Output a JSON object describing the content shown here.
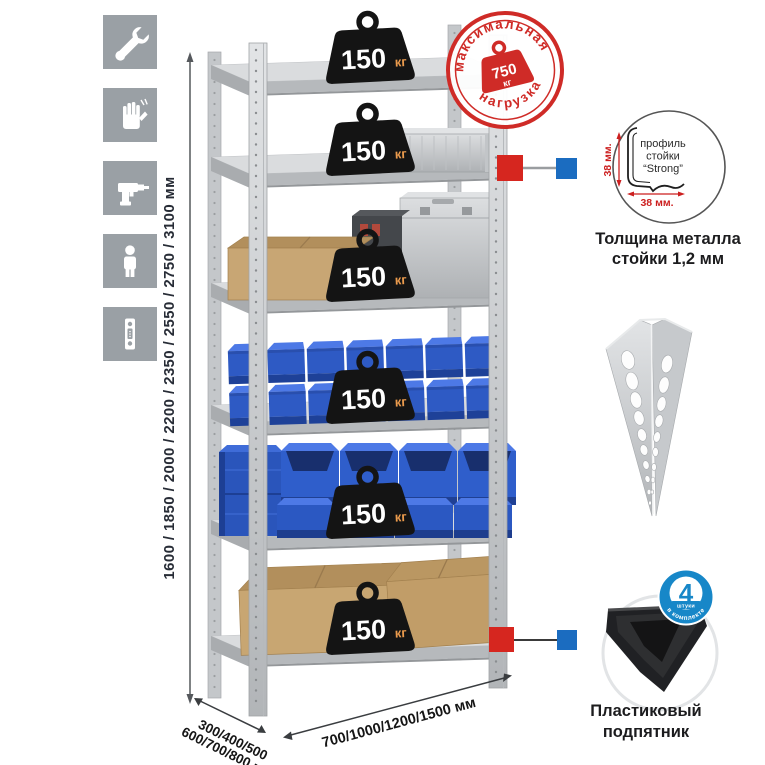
{
  "left_icons": {
    "items": [
      "wrench-icon",
      "gloves-icon",
      "drill-icon",
      "person-icon",
      "perforated-post-icon"
    ]
  },
  "dimensions": {
    "height": "1600 / 1850 / 2000 / 2200 / 2350 / 2550 / 2750 / 3100 мм",
    "depth_line1": "300/400/500",
    "depth_line2": "600/700/800 мм",
    "width": "700/1000/1200/1500 мм"
  },
  "max_load_stamp": {
    "arc_top": "максимальная",
    "arc_bottom": "нагрузка",
    "value": "750",
    "unit": "кг"
  },
  "shelf_load": {
    "value": "150",
    "unit": "кг"
  },
  "profile_detail": {
    "line1": "профиль",
    "line2": "стойки",
    "line3": "“Strong”",
    "dim_vertical": "38 мм.",
    "dim_horizontal": "38 мм.",
    "caption_line1": "Толщина металла",
    "caption_line2": "стойки 1,2 мм"
  },
  "foot_detail": {
    "badge_value": "4",
    "badge_unit": "штуки",
    "badge_arc": "в комплекте",
    "caption_line1": "Пластиковый",
    "caption_line2": "подпятник"
  },
  "colors": {
    "stamp_red": "#cf2b27",
    "badge_blue": "#1787c8",
    "bin_blue": "#2f5ecb",
    "metal_gray": "#cfd2d4",
    "accent_red": "#d6261f",
    "accent_blue": "#1b6cc0",
    "weight_black": "#141414",
    "kg_orange": "#eb9b4d"
  }
}
